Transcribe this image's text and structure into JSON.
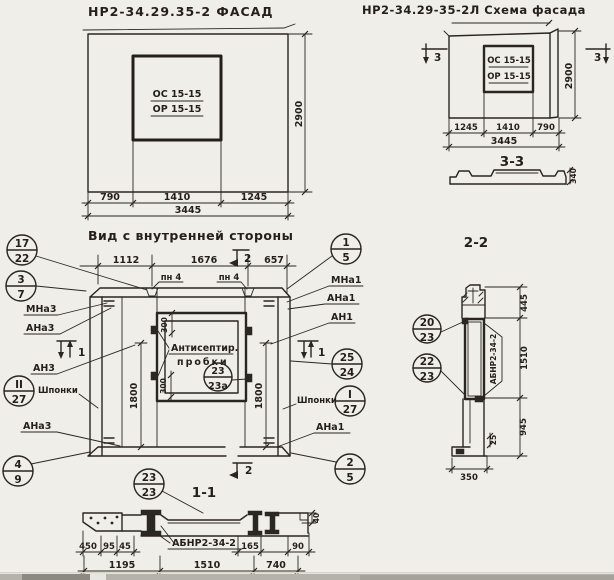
{
  "page": {
    "paper_color": "#f0eee8",
    "ink_color": "#2a2520"
  },
  "titles": {
    "left": "НР2-34.29.35-2 ФАСАД",
    "right": "НР2-34.29-35-2Л Схема фасада",
    "inner_view": "Вид с внутренней стороны",
    "s11": "1-1",
    "s22": "2-2",
    "s33": "3-3"
  },
  "facade": {
    "os": "ОС 15-15",
    "or": "ОР 15-15",
    "d790": "790",
    "d1410": "1410",
    "d1245": "1245",
    "d3445": "3445",
    "d2900": "2900"
  },
  "schema": {
    "os": "ОС 15-15",
    "or": "ОР 15-15",
    "d1245": "1245",
    "d1410": "1410",
    "d790": "790",
    "d3445": "3445",
    "d2900": "2900",
    "mark3L": "3",
    "mark3R": "3",
    "d340": "340"
  },
  "inner": {
    "d1112": "1112",
    "d1676": "1676",
    "d657": "657",
    "pn4a": "пн 4",
    "pn4b": "пн 4",
    "anti1": "Антисептир.",
    "anti2": "пробки",
    "d1800L": "1800",
    "d1800R": "1800",
    "d300t": "300",
    "d300b": "300",
    "mna3": "МНа3",
    "ana3": "АНа3",
    "an3": "АН3",
    "shponki_l": "Шпонки",
    "ana3b": "АНа3",
    "mna1": "МНа1",
    "ana1": "АНа1",
    "an1": "АН1",
    "shponki_r": "Шпонки",
    "ana1b": "АНа1",
    "m1a": "1",
    "m1b": "1",
    "m2t": "2",
    "m2b": "2"
  },
  "callouts": {
    "c17_22": {
      "t": "17",
      "b": "22"
    },
    "c3_7": {
      "t": "3",
      "b": "7"
    },
    "cII_27": {
      "t": "II",
      "b": "27"
    },
    "c4_9": {
      "t": "4",
      "b": "9"
    },
    "c1_5": {
      "t": "1",
      "b": "5"
    },
    "c25_24": {
      "t": "25",
      "b": "24"
    },
    "cI_27": {
      "t": "I",
      "b": "27"
    },
    "c2_5": {
      "t": "2",
      "b": "5"
    },
    "c23_23a": {
      "t": "23",
      "b": "23а"
    },
    "c23_23": {
      "t": "23",
      "b": "23"
    },
    "c20_23": {
      "t": "20",
      "b": "23"
    },
    "c22_23": {
      "t": "22",
      "b": "23"
    }
  },
  "s11": {
    "stamp": "АБНР2-34-2",
    "d450": "450",
    "d95": "95",
    "d45": "45",
    "d165": "165",
    "d90": "90",
    "d1195": "1195",
    "d1510": "1510",
    "d740": "740",
    "d40": "40"
  },
  "s22": {
    "stamp": "АБНР2-34-2",
    "d445": "445",
    "d1510": "1510",
    "d945": "945",
    "d25": "25",
    "d350": "350"
  }
}
